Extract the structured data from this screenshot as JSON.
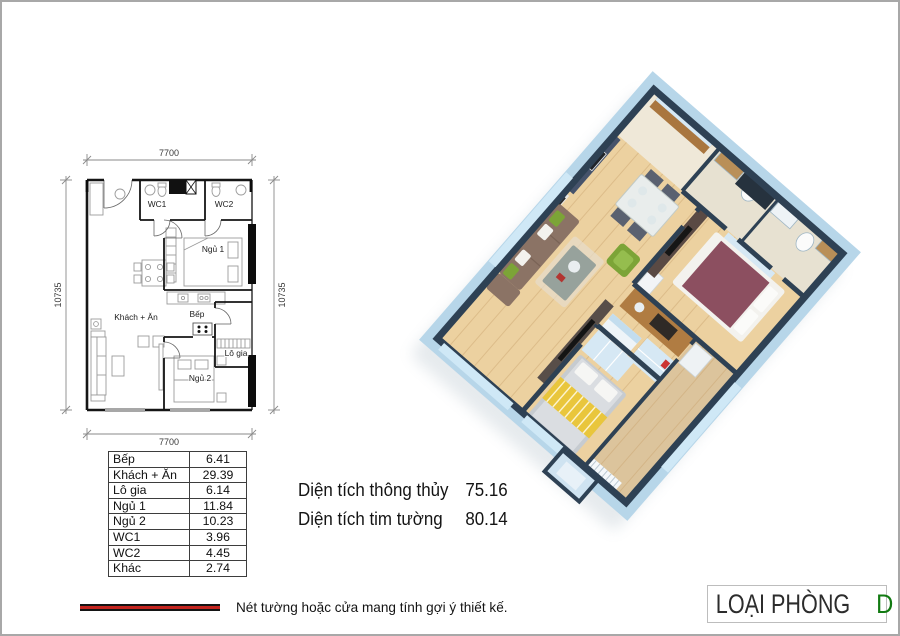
{
  "plan2d": {
    "dim_top": "7700",
    "dim_bottom": "7700",
    "dim_left": "10735",
    "dim_right": "10735",
    "labels": {
      "wc1": "WC1",
      "wc2": "WC2",
      "ngu1": "Ngủ 1",
      "khach_an": "Khách + Ăn",
      "bep": "Bếp",
      "lo_gia": "Lô gia",
      "ngu2": "Ngủ 2"
    }
  },
  "area_table": {
    "rows": [
      {
        "label": "Bếp",
        "value": "6.41"
      },
      {
        "label": "Khách + Ăn",
        "value": "29.39"
      },
      {
        "label": "Lô gia",
        "value": "6.14"
      },
      {
        "label": "Ngủ 1",
        "value": "11.84"
      },
      {
        "label": "Ngủ 2",
        "value": "10.23"
      },
      {
        "label": "WC1",
        "value": "3.96"
      },
      {
        "label": "WC2",
        "value": "4.45"
      },
      {
        "label": "Khác",
        "value": "2.74"
      }
    ]
  },
  "areas": {
    "row1": {
      "label": "Diện tích thông thủy",
      "value": "75.16"
    },
    "row2": {
      "label": "Diện tích tim tường",
      "value": "80.14"
    }
  },
  "legend": {
    "note": "Nét tường hoặc cửa mang tính gợi ý thiết kế."
  },
  "room_type": {
    "label": "LOẠI PHÒNG",
    "value": "D"
  },
  "colors": {
    "room_type_accent": "#127a12",
    "legend_line_red": "#c4241f",
    "wall_top": "#2e4154",
    "wall_side": "#b7d6e9",
    "glass_blue": "#cfe8f6",
    "floor_wood": "#ecd1a0",
    "accent_green": "#7ca437",
    "sofa_brown": "#8b7365",
    "bed1_maroon": "#8c4f60",
    "bed2_yellow": "#e9c63c",
    "wardrobe_blue": "#d6e8f4"
  }
}
